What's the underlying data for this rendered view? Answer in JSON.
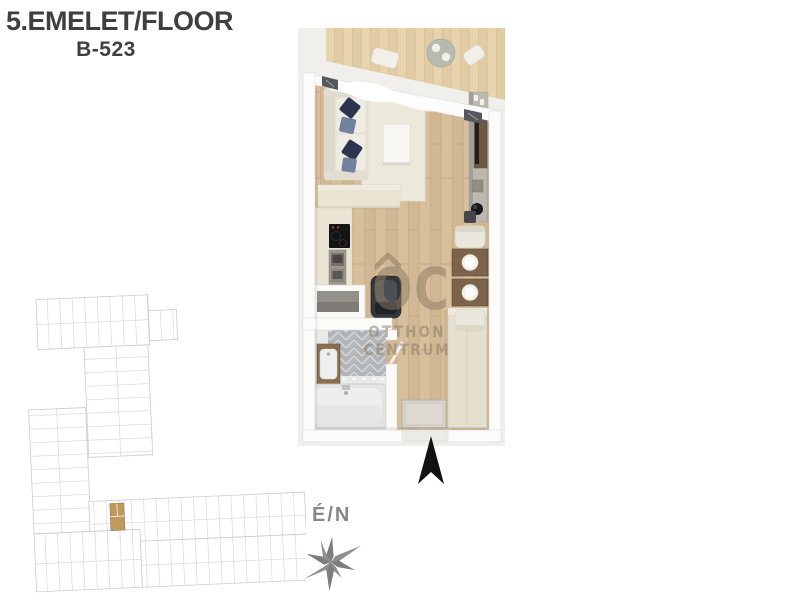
{
  "header": {
    "floor_title": "5.EMELET/FLOOR",
    "unit_number": "B-523"
  },
  "compass": {
    "label": "É/N"
  },
  "watermark": {
    "monogram": "OC",
    "line1": "OTTHON",
    "line2": "CENTRUM"
  },
  "colors": {
    "title_text": "#3f3f42",
    "plan_background": "#f1efec",
    "wall": "#fbfbfa",
    "wood_floor": "#d8bf9c",
    "balcony_wood": "#e7d3ad",
    "rug": "#ece9db",
    "sofa": "#e8e4d8",
    "pillow_navy": "#2c3550",
    "pillow_slate": "#72819e",
    "kitchen_counter": "#e9e4d4",
    "cooktop": "#141417",
    "cooktop_indicator": "#c43b30",
    "armchair_dark": "#33373c",
    "dining_table": "#7c6349",
    "tv_board": "#6d5944",
    "bathroom_tile": "#b4b7ba",
    "bathtub": "#edefee",
    "vanity_wood": "#8a6f4e",
    "wardrobe": "#e4dfcf",
    "doormat": "#d7d3c9",
    "watermark": "#8c7b65",
    "site_plan_line": "#cbc9d6",
    "site_plan_highlight": "#c0995f",
    "north_arrow": "#121214",
    "compass_gray": "#8f8f92"
  }
}
